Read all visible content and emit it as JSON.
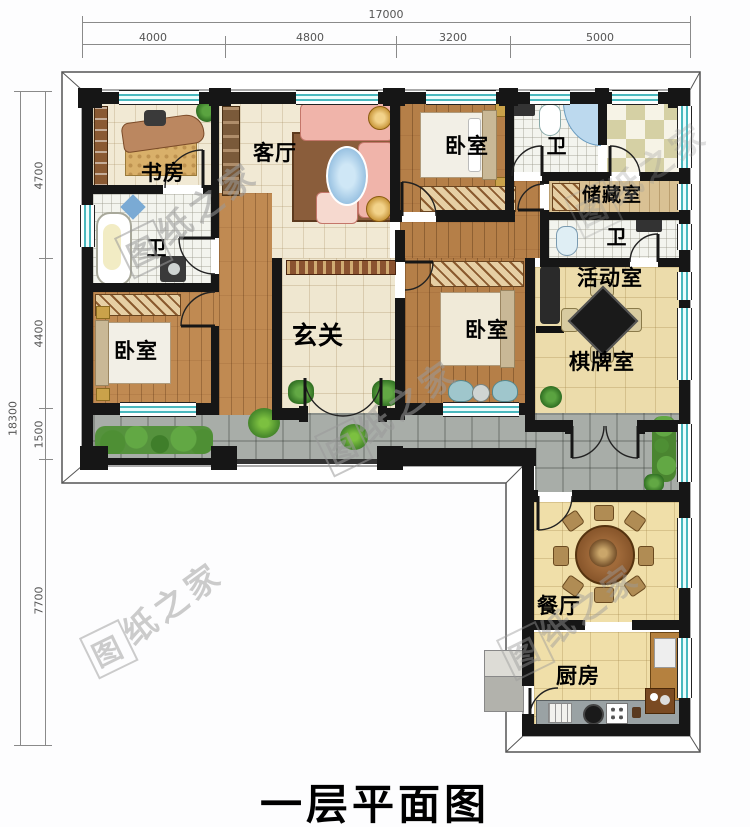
{
  "title": "一层平面图",
  "watermark": {
    "boxed": "图",
    "text": "纸之家"
  },
  "dimensions": {
    "top": {
      "total": "17000",
      "segments": [
        "4000",
        "4800",
        "3200",
        "5000"
      ]
    },
    "left": {
      "total": "18300",
      "segments": [
        "4700",
        "4400",
        "1500",
        "7700"
      ]
    }
  },
  "rooms": {
    "study": {
      "label": "书房"
    },
    "living": {
      "label": "客厅"
    },
    "bedroom_top": {
      "label": "卧室"
    },
    "bath_top": {
      "label": "卫"
    },
    "storage": {
      "label": "储藏室"
    },
    "bath_mid": {
      "label": "卫"
    },
    "activity": {
      "label": "活动室"
    },
    "chess": {
      "label": "棋牌室"
    },
    "foyer": {
      "label": "玄关"
    },
    "bedroom_mid": {
      "label": "卧室"
    },
    "bedroom_left": {
      "label": "卧室"
    },
    "bath_left": {
      "label": "卫"
    },
    "dining": {
      "label": "餐厅"
    },
    "kitchen": {
      "label": "厨房"
    }
  }
}
